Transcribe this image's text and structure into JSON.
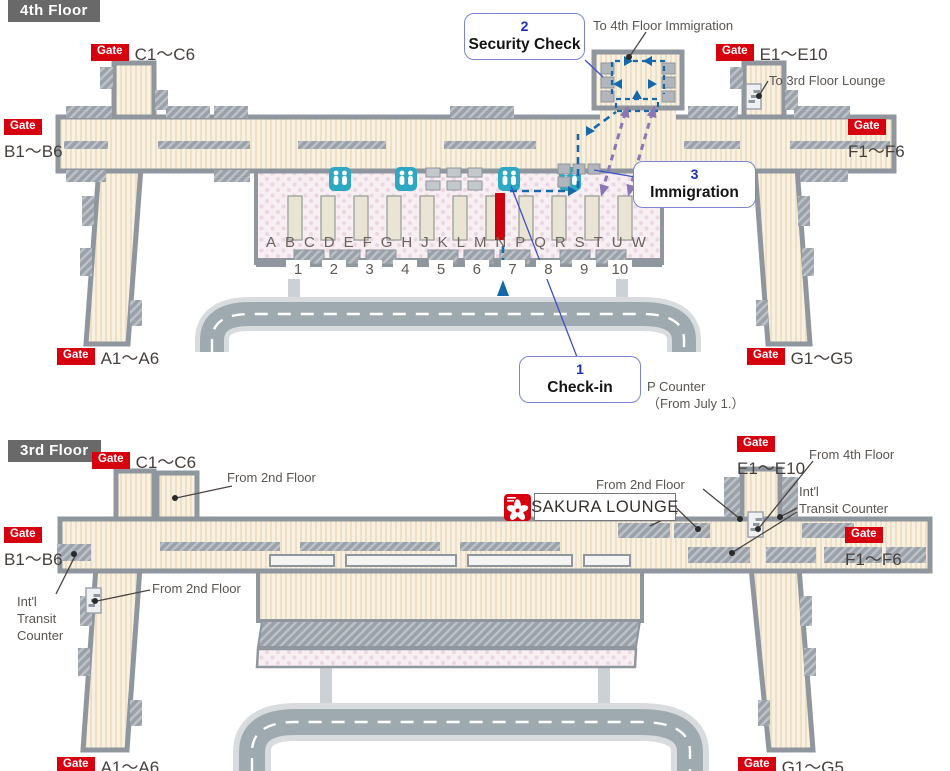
{
  "ui": {
    "gate_badge": "Gate"
  },
  "floor4": {
    "title": "4th Floor",
    "gates": {
      "c": "C1～C6",
      "e": "E1～E10",
      "b": "B1～B6",
      "f": "F1～F6",
      "a": "A1～A6",
      "g": "G1～G5"
    },
    "steps": {
      "checkin": {
        "num": "1",
        "label": "Check-in"
      },
      "security": {
        "num": "2",
        "label": "Security Check"
      },
      "immigration": {
        "num": "3",
        "label": "Immigration"
      }
    },
    "notes": {
      "to_4f_immigration": "To 4th Floor Immigration",
      "to_3f_lounge": "To 3rd Floor Lounge",
      "p_counter": "P Counter\n（From July 1.）"
    },
    "checkin_letters": [
      "A",
      "B",
      "C",
      "D",
      "E",
      "F",
      "G",
      "H",
      "J",
      "K",
      "L",
      "M",
      "N",
      "P",
      "Q",
      "R",
      "S",
      "T",
      "U",
      "W"
    ],
    "checkin_numbers": [
      "1",
      "2",
      "3",
      "4",
      "5",
      "6",
      "7",
      "8",
      "9",
      "10"
    ]
  },
  "floor3": {
    "title": "3rd Floor",
    "gates": {
      "c": "C1～C6",
      "e": "E1～E10",
      "b": "B1～B6",
      "f": "F1～F6",
      "a": "A1～A6",
      "g": "G1～G5"
    },
    "notes": {
      "from_2nd_c": "From 2nd Floor",
      "from_2nd_center": "From 2nd Floor",
      "from_2nd_left": "From 2nd Floor",
      "from_4th": "From 4th Floor",
      "intl_right": "Int'l\nTransit Counter",
      "intl_left": "Int'l\nTransit\nCounter",
      "sakura": "SAKURA LOUNGE"
    }
  },
  "colors": {
    "gate_red": "#d7000f",
    "title_gray": "#696969",
    "wall_gray": "#8f969e",
    "corridor_beige": "#f8f0e0",
    "hall_pink": "#f8eff3",
    "road_gray": "#9faab0",
    "route_blue": "#1668ab",
    "route_purple": "#8a77b5",
    "step_blue": "#1b2fc0",
    "restroom_teal": "#2ea7c3",
    "counter_red": "#cf000e"
  }
}
